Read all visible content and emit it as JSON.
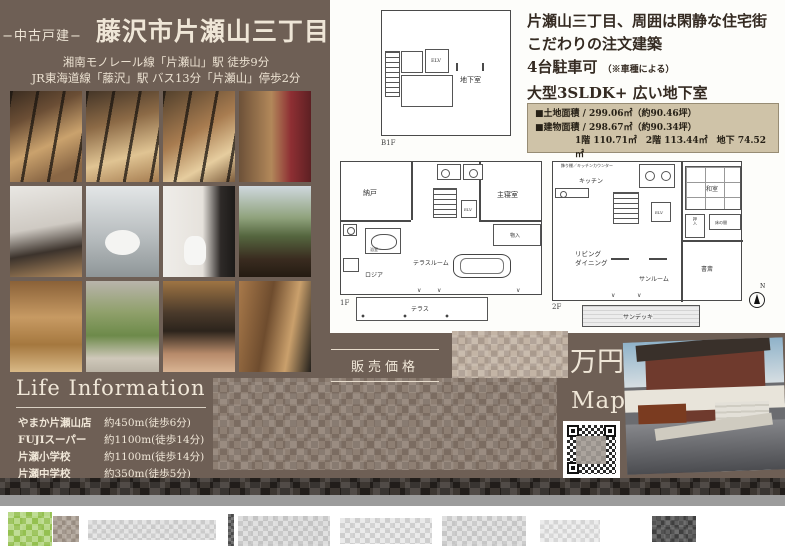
{
  "colors": {
    "flyer_brown": "#6e5f55",
    "cream_text": "#f0e7d8",
    "area_box_tan": "#cfc3a8",
    "dark_text": "#352b22",
    "footer_gray": "#9c9c9c",
    "logo_green": "#94c050"
  },
  "header": {
    "category": "−中古戸建−",
    "title": "藤沢市片瀬山三丁目",
    "access_line1": "湘南モノレール線「片瀬山」駅 徒歩9分",
    "access_line2": "JR東海道線「藤沢」駅 バス13分「片瀬山」停歩2分"
  },
  "features": {
    "line1": "片瀬山三丁目、周囲は閑静な住宅街",
    "line2": "こだわりの注文建築",
    "line3_main": "4台駐車可",
    "line3_note": "（※車種による）",
    "line4": "大型3SLDK+ 広い地下室"
  },
  "area_box": {
    "land": "■土地面積 / 299.06㎡（約90.46坪）",
    "building": "■建物面積 / 298.67㎡（約90.34坪）",
    "floors": "1階 110.71㎡　2階 113.44㎡　地下 74.52㎡"
  },
  "plans": {
    "b1f": {
      "floor_label": "B1F",
      "elv": "ELV",
      "basement": "地下室"
    },
    "f1": {
      "floor_label": "1F",
      "nando": "納戸",
      "bedroom": "主寝室",
      "elv": "ELV",
      "bath": "浴室",
      "storage": "物入",
      "loggia": "ロジア",
      "terrace_room": "テラスルーム",
      "terrace": "テラス"
    },
    "f2": {
      "floor_label": "2F",
      "counter_note": "飾り棚／キッチンカウンター",
      "kitchen": "キッチン",
      "living": "リビング",
      "dining": "ダイニング",
      "sunroom": "サンルーム",
      "washitsu": "和室",
      "oshiire": "押入",
      "tokonoma": "床の間",
      "study": "書斎",
      "elv": "ELV",
      "sundeck": "サンデッキ",
      "compass_n": "N"
    }
  },
  "price": {
    "label": "販売価格",
    "unit": "万円"
  },
  "map": {
    "label": "Map"
  },
  "life_information": {
    "title": "Life Information",
    "note": "※80m=1分",
    "items": [
      {
        "name": "やまか片瀬山店",
        "distance": "約450m(徒歩6分)"
      },
      {
        "name": "FUJIスーパー",
        "distance": "約1100m(徒歩14分)"
      },
      {
        "name": "片瀬小学校",
        "distance": "約1100m(徒歩14分)"
      },
      {
        "name": "片瀬中学校",
        "distance": "約350m(徒歩5分)"
      }
    ]
  }
}
